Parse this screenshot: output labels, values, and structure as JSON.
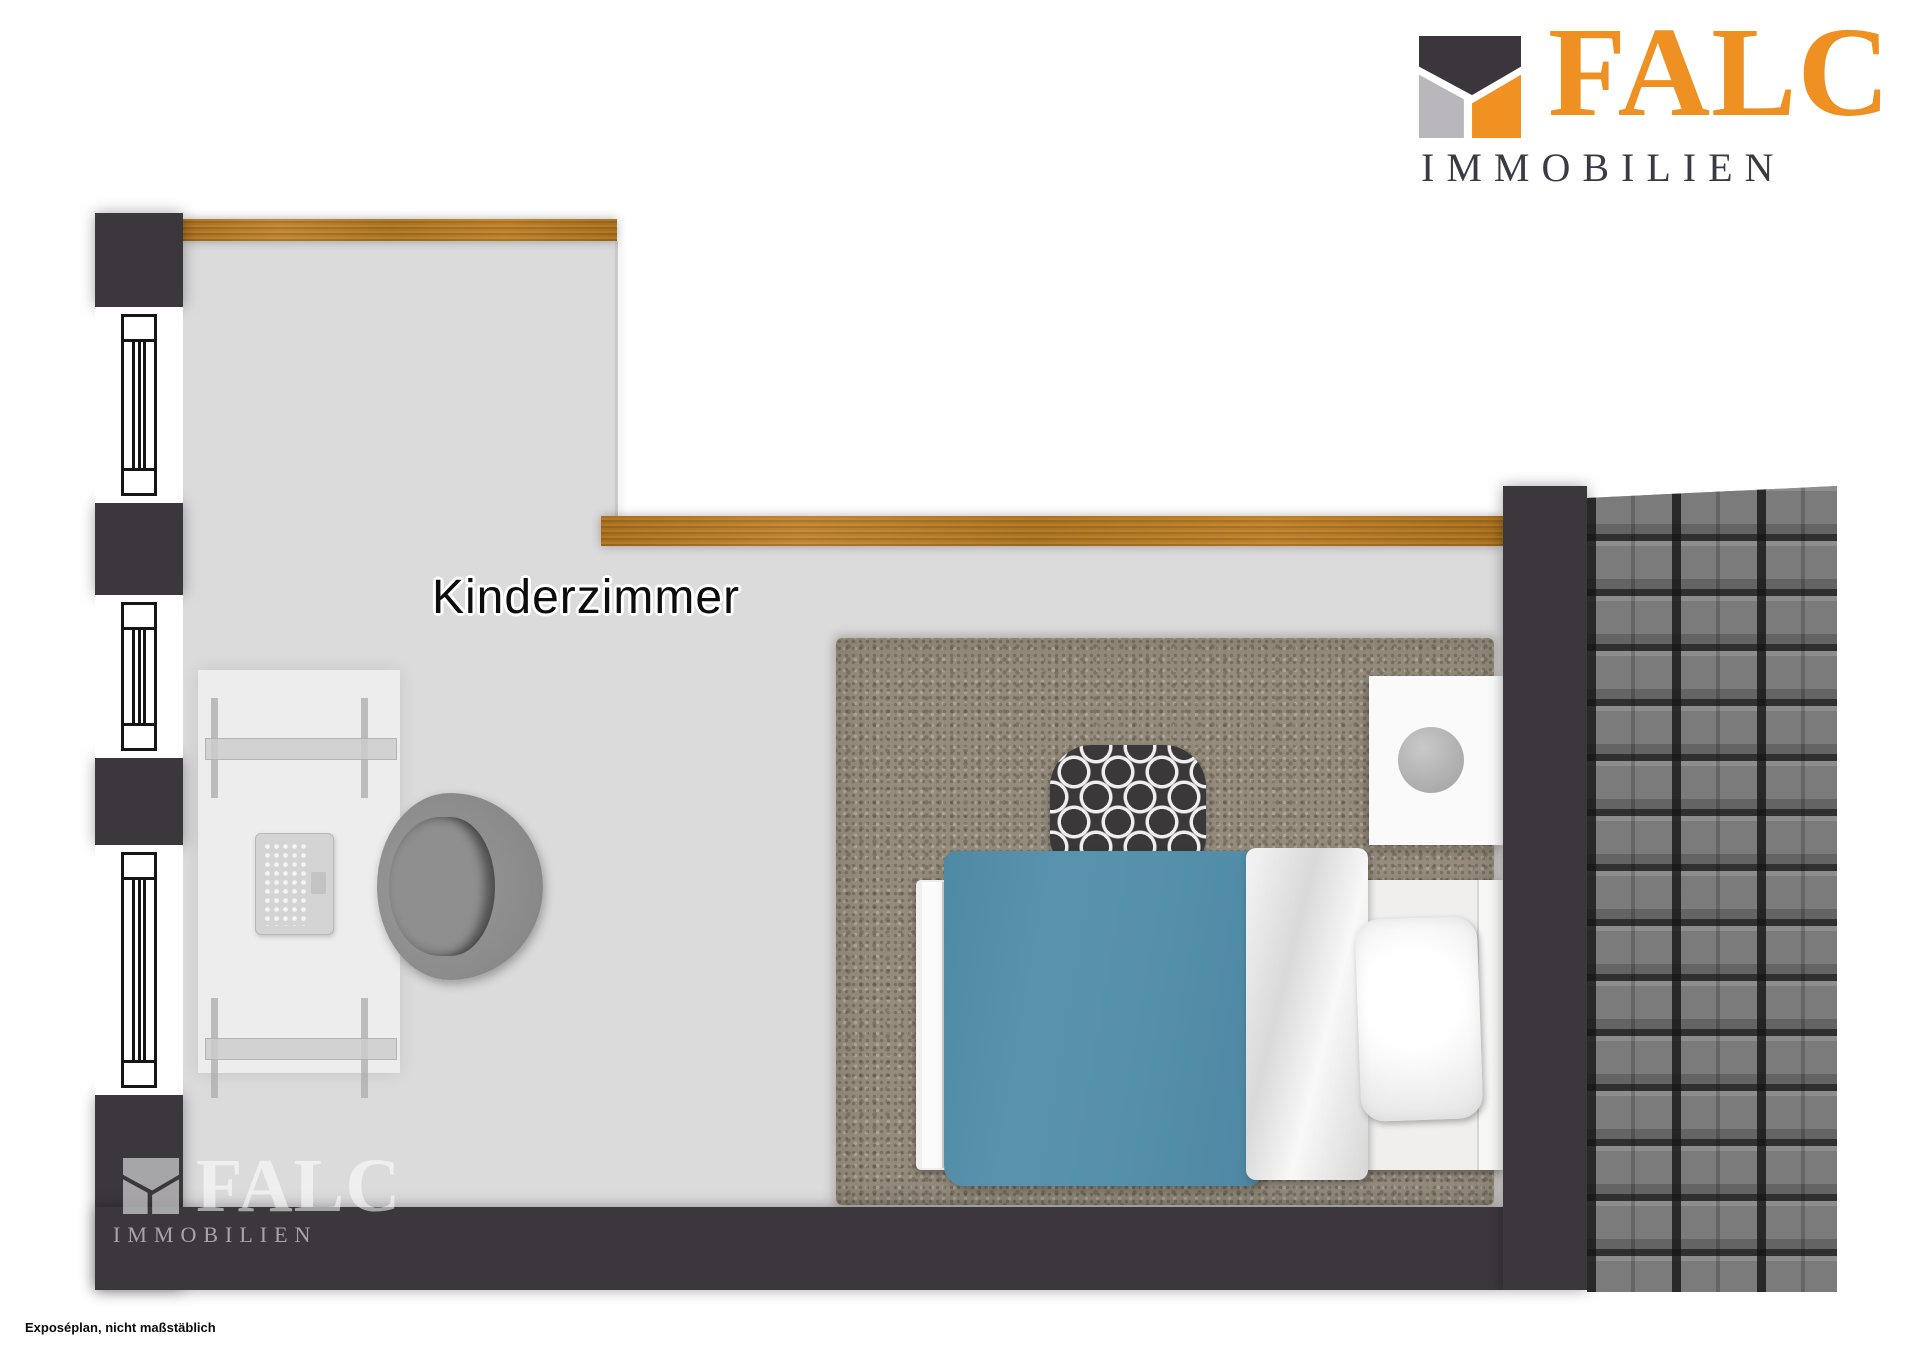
{
  "header_logo": {
    "brand": "FALC",
    "subtitle": "IMMOBILIEN"
  },
  "room": {
    "label": "Kinderzimmer"
  },
  "watermark": {
    "brand": "FALC",
    "subtitle": "IMMOBILIEN"
  },
  "footnote": {
    "text": "Exposéplan, nicht maßstäblich"
  },
  "icons": {
    "logo_mark": "falc-falcon-mark",
    "window_symbol": "double-frame-window",
    "lamp": "round-lamp"
  },
  "colors": {
    "brand-orange": "#EF9122",
    "brand-dark": "#3A3A44",
    "brand-gray": "#B9B7BC",
    "wall": "#3B373C",
    "floor": "#DBDBDC",
    "wood": "#B5791F",
    "roof": "#7A7A7A",
    "rug": "#958C7D",
    "blanket-blue": "#5590AA"
  }
}
